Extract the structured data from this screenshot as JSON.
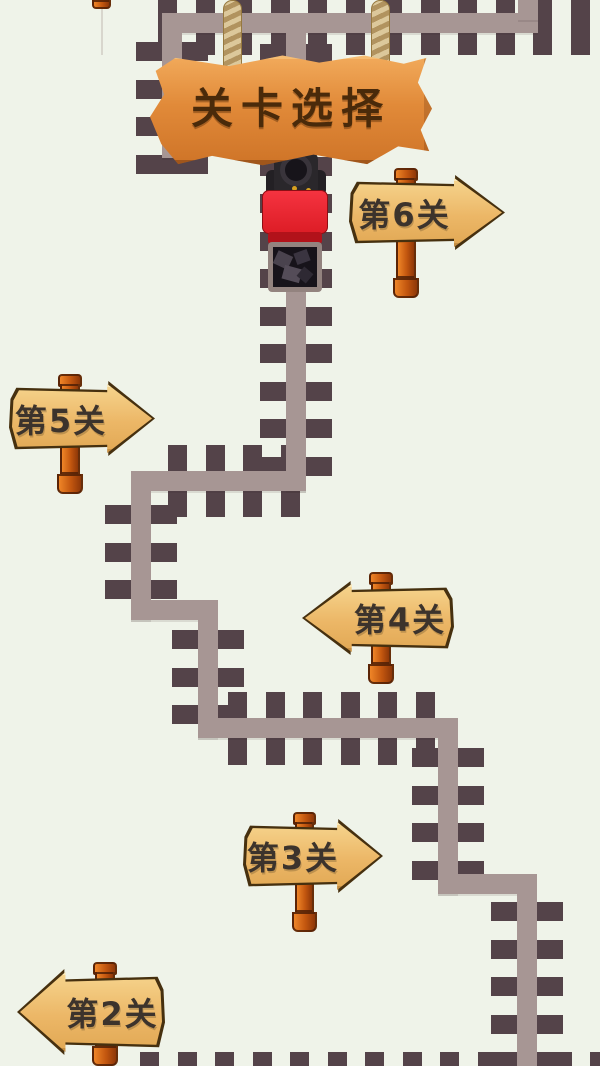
{
  "banner": {
    "title": "关卡选择"
  },
  "signs": [
    {
      "id": "level-6",
      "label": "第6关",
      "direction": "right",
      "board": {
        "x": 352,
        "y": 178,
        "w": 150,
        "h": 69
      },
      "post": {
        "x": 396,
        "w": 20,
        "top": 168,
        "bottom": 298
      }
    },
    {
      "id": "level-5",
      "label": "第5关",
      "direction": "right",
      "board": {
        "x": 12,
        "y": 384,
        "w": 140,
        "h": 69
      },
      "post": {
        "x": 60,
        "w": 20,
        "top": 374,
        "bottom": 494
      }
    },
    {
      "id": "level-4",
      "label": "第4关",
      "direction": "left",
      "board": {
        "x": 305,
        "y": 584,
        "w": 146,
        "h": 68
      },
      "post": {
        "x": 371,
        "w": 20,
        "top": 572,
        "bottom": 684
      }
    },
    {
      "id": "level-3",
      "label": "第3关",
      "direction": "right",
      "board": {
        "x": 246,
        "y": 822,
        "w": 134,
        "h": 68
      },
      "post": {
        "x": 295,
        "w": 19,
        "top": 812,
        "bottom": 932
      }
    },
    {
      "id": "level-2",
      "label": "第2关",
      "direction": "left",
      "board": {
        "x": 20,
        "y": 972,
        "w": 142,
        "h": 80
      },
      "post": {
        "x": 95,
        "w": 20,
        "top": 962,
        "bottom": 1066
      }
    }
  ],
  "train": {
    "x": 258,
    "y": 148,
    "at_level": "第6关"
  },
  "track": {
    "beds": [
      {
        "x": 162,
        "y": 13,
        "w": 376,
        "h": 20
      },
      {
        "x": 518,
        "y": 0,
        "w": 20,
        "h": 20
      },
      {
        "x": 162,
        "y": 13,
        "w": 20,
        "h": 145
      },
      {
        "x": 286,
        "y": 13,
        "w": 20,
        "h": 478
      },
      {
        "x": 131,
        "y": 471,
        "w": 175,
        "h": 20
      },
      {
        "x": 131,
        "y": 471,
        "w": 20,
        "h": 149
      },
      {
        "x": 131,
        "y": 600,
        "w": 87,
        "h": 20
      },
      {
        "x": 198,
        "y": 600,
        "w": 20,
        "h": 138
      },
      {
        "x": 198,
        "y": 718,
        "w": 260,
        "h": 20
      },
      {
        "x": 438,
        "y": 718,
        "w": 20,
        "h": 176
      },
      {
        "x": 438,
        "y": 874,
        "w": 99,
        "h": 20
      },
      {
        "x": 517,
        "y": 874,
        "w": 20,
        "h": 192
      }
    ],
    "tie_runs": [
      {
        "axis": "x",
        "from": 158,
        "to": 600,
        "at": 0,
        "len": 55,
        "thick": 19,
        "step": 37.5
      },
      {
        "axis": "y",
        "from": 42,
        "to": 174,
        "at": 136,
        "len": 72,
        "thick": 19,
        "step": 37.5
      },
      {
        "axis": "y",
        "from": 44,
        "to": 470,
        "at": 260,
        "len": 72,
        "thick": 19,
        "step": 37.5
      },
      {
        "axis": "x",
        "from": 168,
        "to": 285,
        "at": 445,
        "len": 72,
        "thick": 19,
        "step": 37.5
      },
      {
        "axis": "y",
        "from": 505,
        "to": 600,
        "at": 105,
        "len": 72,
        "thick": 19,
        "step": 37.5
      },
      {
        "axis": "y",
        "from": 630,
        "to": 715,
        "at": 172,
        "len": 72,
        "thick": 19,
        "step": 37.5
      },
      {
        "axis": "x",
        "from": 228,
        "to": 432,
        "at": 692,
        "len": 73,
        "thick": 19,
        "step": 37.5
      },
      {
        "axis": "y",
        "from": 748,
        "to": 868,
        "at": 412,
        "len": 72,
        "thick": 19,
        "step": 37.5
      },
      {
        "axis": "y",
        "from": 902,
        "to": 1062,
        "at": 491,
        "len": 72,
        "thick": 19,
        "step": 37.5
      },
      {
        "axis": "x",
        "from": 140,
        "to": 600,
        "at": 1052,
        "len": 14,
        "thick": 19,
        "step": 37.5
      }
    ]
  },
  "colors": {
    "background": "#eff3e9",
    "tie": "#544349",
    "bed": "#a79694",
    "banner_wood": "#e18a39",
    "banner_text": "#4a2a0a",
    "sign_wood": "#ecb767",
    "sign_outline": "#46300f",
    "sign_text": "#3c332c",
    "post": "#c2560f",
    "rope": "#c9b183",
    "train_red": "#e8232b",
    "train_black": "#29262a",
    "coal": "#17131a"
  }
}
